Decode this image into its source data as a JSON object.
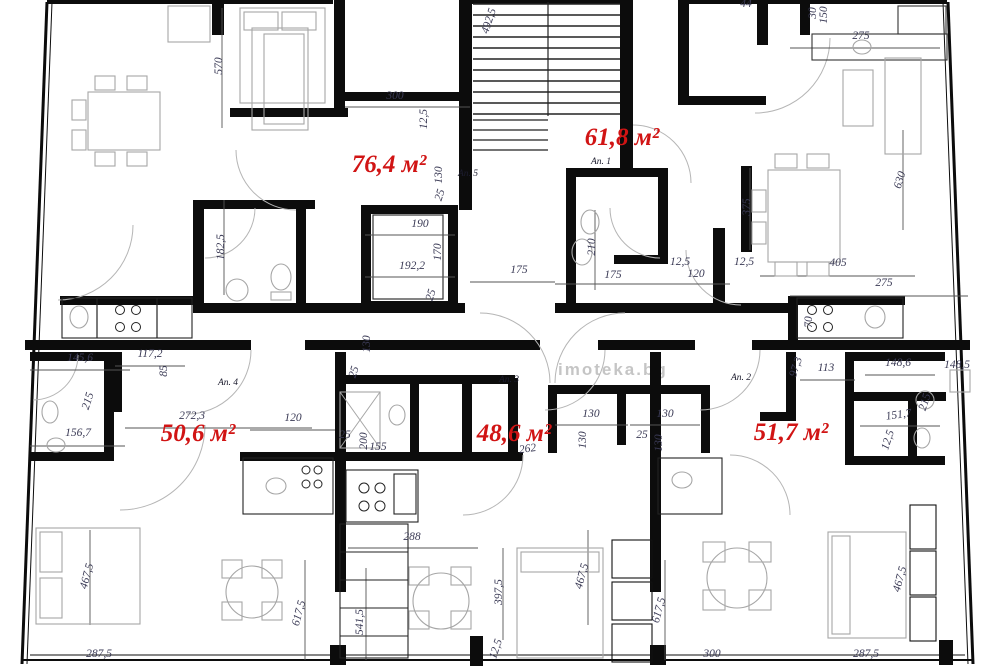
{
  "watermark": {
    "text": "imoteka.bg"
  },
  "colors": {
    "area_label": "#d11414",
    "dimension_text": "#3a3a55",
    "wall": "#0c0c0c",
    "furniture": "#a6a6a6",
    "watermark": "#9f9f9f"
  },
  "apartments": [
    {
      "number_label": "Ап. 5",
      "area_label": "76,4 м²",
      "ax": 389,
      "ay": 172,
      "nx": 468,
      "ny": 176
    },
    {
      "number_label": "Ап. 1",
      "area_label": "61,8 м²",
      "ax": 622,
      "ay": 145,
      "nx": 601,
      "ny": 164
    },
    {
      "number_label": "Ап. 4",
      "area_label": "50,6 м²",
      "ax": 198,
      "ay": 441,
      "nx": 228,
      "ny": 385
    },
    {
      "number_label": "Ап. 3",
      "area_label": "48,6 м²",
      "ax": 514,
      "ay": 441,
      "nx": 509,
      "ny": 382
    },
    {
      "number_label": "Ап. 2",
      "area_label": "51,7 м²",
      "ax": 791,
      "ay": 440,
      "nx": 741,
      "ny": 380
    }
  ],
  "dimensions": [
    {
      "t": "570",
      "x": 222,
      "y": 66,
      "r": -90
    },
    {
      "t": "300",
      "x": 395,
      "y": 99,
      "r": 0
    },
    {
      "t": "12,5",
      "x": 427,
      "y": 119,
      "r": -90
    },
    {
      "t": "492,5",
      "x": 492,
      "y": 22,
      "r": -72
    },
    {
      "t": "182,5",
      "x": 224,
      "y": 247,
      "r": -90
    },
    {
      "t": "190",
      "x": 420,
      "y": 227,
      "r": 0
    },
    {
      "t": "170",
      "x": 441,
      "y": 252,
      "r": -90
    },
    {
      "t": "192,2",
      "x": 412,
      "y": 269,
      "r": 0
    },
    {
      "t": "25",
      "x": 434,
      "y": 296,
      "r": -72
    },
    {
      "t": "130",
      "x": 442,
      "y": 175,
      "r": -90
    },
    {
      "t": "25",
      "x": 443,
      "y": 196,
      "r": -72
    },
    {
      "t": "175",
      "x": 519,
      "y": 273,
      "r": 0
    },
    {
      "t": "210",
      "x": 595,
      "y": 247,
      "r": -90
    },
    {
      "t": "175",
      "x": 613,
      "y": 278,
      "r": 0
    },
    {
      "t": "12,5",
      "x": 680,
      "y": 265,
      "r": 0
    },
    {
      "t": "120",
      "x": 696,
      "y": 277,
      "r": 0
    },
    {
      "t": "12,5",
      "x": 744,
      "y": 265,
      "r": 0
    },
    {
      "t": "375",
      "x": 750,
      "y": 207,
      "r": -90
    },
    {
      "t": "405",
      "x": 838,
      "y": 266,
      "r": 0
    },
    {
      "t": "275",
      "x": 884,
      "y": 286,
      "r": 0
    },
    {
      "t": "70",
      "x": 812,
      "y": 322,
      "r": -90
    },
    {
      "t": "44",
      "x": 746,
      "y": 7,
      "r": 0
    },
    {
      "t": "30",
      "x": 816,
      "y": 13,
      "r": -90
    },
    {
      "t": "150",
      "x": 827,
      "y": 15,
      "r": -90
    },
    {
      "t": "275",
      "x": 861,
      "y": 39,
      "r": 0
    },
    {
      "t": "630",
      "x": 903,
      "y": 181,
      "r": -72
    },
    {
      "t": "145,6",
      "x": 80,
      "y": 361,
      "r": 0
    },
    {
      "t": "117,2",
      "x": 150,
      "y": 357,
      "r": 0
    },
    {
      "t": "85",
      "x": 167,
      "y": 371,
      "r": -90
    },
    {
      "t": "215",
      "x": 91,
      "y": 402,
      "r": -72
    },
    {
      "t": "156,7",
      "x": 78,
      "y": 436,
      "r": 0
    },
    {
      "t": "272,3",
      "x": 192,
      "y": 419,
      "r": 0
    },
    {
      "t": "120",
      "x": 293,
      "y": 421,
      "r": 0
    },
    {
      "t": "130",
      "x": 370,
      "y": 344,
      "r": -90
    },
    {
      "t": "25",
      "x": 357,
      "y": 373,
      "r": -72
    },
    {
      "t": "25",
      "x": 345,
      "y": 438,
      "r": 0
    },
    {
      "t": "200",
      "x": 367,
      "y": 441,
      "r": -90
    },
    {
      "t": "155",
      "x": 378,
      "y": 450,
      "r": 0
    },
    {
      "t": "130",
      "x": 591,
      "y": 417,
      "r": 0
    },
    {
      "t": "130",
      "x": 665,
      "y": 417,
      "r": 0
    },
    {
      "t": "130",
      "x": 586,
      "y": 440,
      "r": -90
    },
    {
      "t": "25",
      "x": 642,
      "y": 438,
      "r": 0
    },
    {
      "t": "130",
      "x": 662,
      "y": 443,
      "r": -90
    },
    {
      "t": "262",
      "x": 528,
      "y": 452,
      "r": -8
    },
    {
      "t": "97,3",
      "x": 799,
      "y": 368,
      "r": -72
    },
    {
      "t": "113",
      "x": 826,
      "y": 371,
      "r": 0
    },
    {
      "t": "148,6",
      "x": 898,
      "y": 366,
      "r": 0
    },
    {
      "t": "148,5",
      "x": 957,
      "y": 368,
      "r": 0
    },
    {
      "t": "215",
      "x": 928,
      "y": 403,
      "r": -72
    },
    {
      "t": "151,7",
      "x": 899,
      "y": 418,
      "r": -8
    },
    {
      "t": "12,5",
      "x": 891,
      "y": 441,
      "r": -72
    },
    {
      "t": "288",
      "x": 412,
      "y": 540,
      "r": 0
    },
    {
      "t": "541,5",
      "x": 363,
      "y": 622,
      "r": -90
    },
    {
      "t": "397,5",
      "x": 502,
      "y": 592,
      "r": -90
    },
    {
      "t": "12,5",
      "x": 499,
      "y": 650,
      "r": -72
    },
    {
      "t": "467,5",
      "x": 90,
      "y": 577,
      "r": -75
    },
    {
      "t": "467,5",
      "x": 585,
      "y": 577,
      "r": -75
    },
    {
      "t": "467,5",
      "x": 903,
      "y": 580,
      "r": -75
    },
    {
      "t": "617,5",
      "x": 302,
      "y": 614,
      "r": -75
    },
    {
      "t": "617,5",
      "x": 662,
      "y": 611,
      "r": -75
    },
    {
      "t": "287,5",
      "x": 99,
      "y": 657,
      "r": 0
    },
    {
      "t": "300",
      "x": 712,
      "y": 657,
      "r": 0
    },
    {
      "t": "287,5",
      "x": 866,
      "y": 657,
      "r": 0
    }
  ]
}
